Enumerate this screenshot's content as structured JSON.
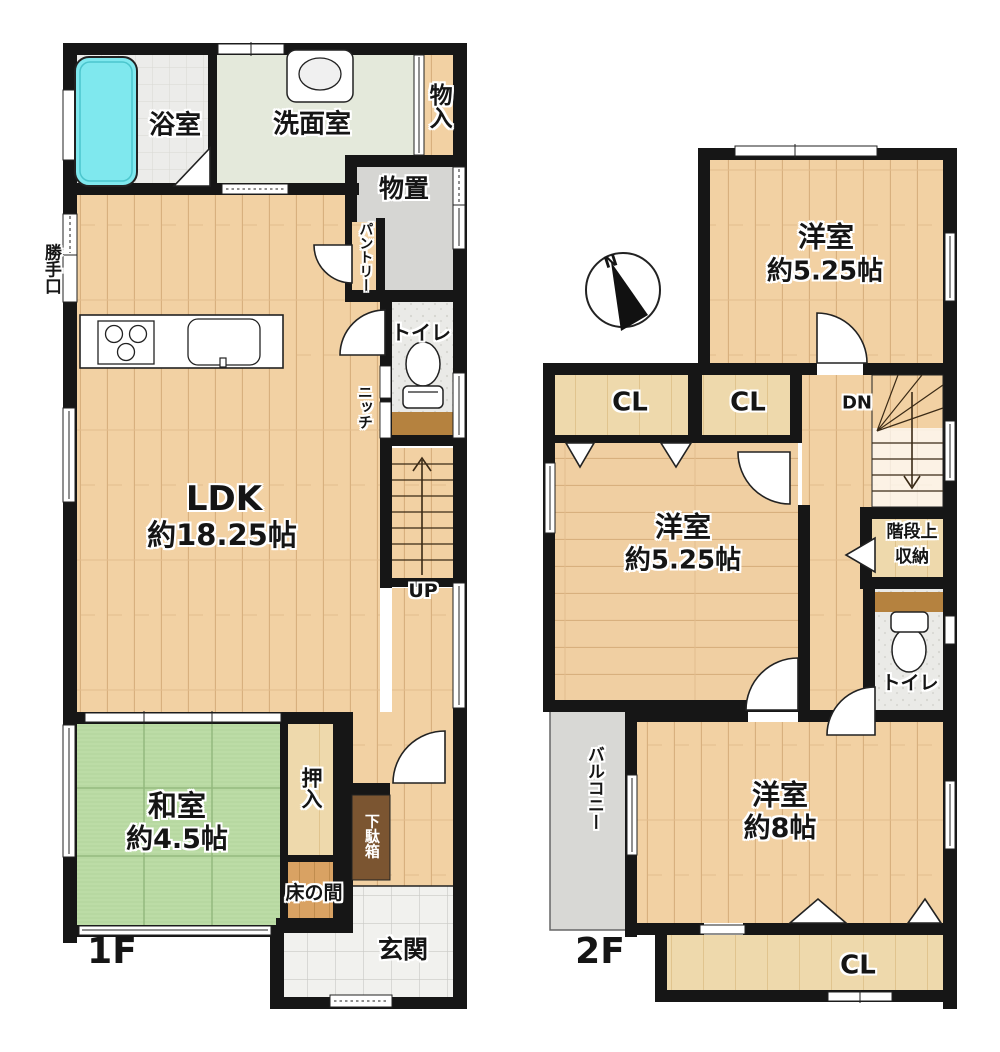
{
  "floor1": {
    "floor_label": "1F",
    "bath": "浴室",
    "washroom": "洗面室",
    "storage_upper": "物入",
    "storage_room": "物置",
    "pantry": "パントリー",
    "toilet": "トイレ",
    "niche": "ニッチ",
    "ldk_name": "LDK",
    "ldk_size": "約18.25帖",
    "stairs_up": "UP",
    "back_door": "勝手口",
    "tatami_name": "和室",
    "tatami_size": "約4.5帖",
    "closet": "押入",
    "shoe_box": "下駄箱",
    "alcove": "床の間",
    "entrance": "玄関"
  },
  "floor2": {
    "floor_label": "2F",
    "compass_north": "N",
    "bedroom1_name": "洋室",
    "bedroom1_size": "約5.25帖",
    "closet1": "CL",
    "closet2": "CL",
    "stairs_down": "DN",
    "stair_storage_line1": "階段上",
    "stair_storage_line2": "収納",
    "bedroom2_name": "洋室",
    "bedroom2_size": "約5.25帖",
    "toilet": "トイレ",
    "balcony": "バルコニー",
    "bedroom3_name": "洋室",
    "bedroom3_size": "約8帖",
    "closet3": "CL"
  },
  "colors": {
    "wall": "#161616",
    "wood": "#f2d1a3",
    "tatami": "#bcdca6",
    "bathtub": "#7fe8ee",
    "storage_gray": "#d6d6d3",
    "closet_tan": "#eed9ac",
    "dark_wood": "#7b5531",
    "counter_brown": "#b5823f"
  }
}
